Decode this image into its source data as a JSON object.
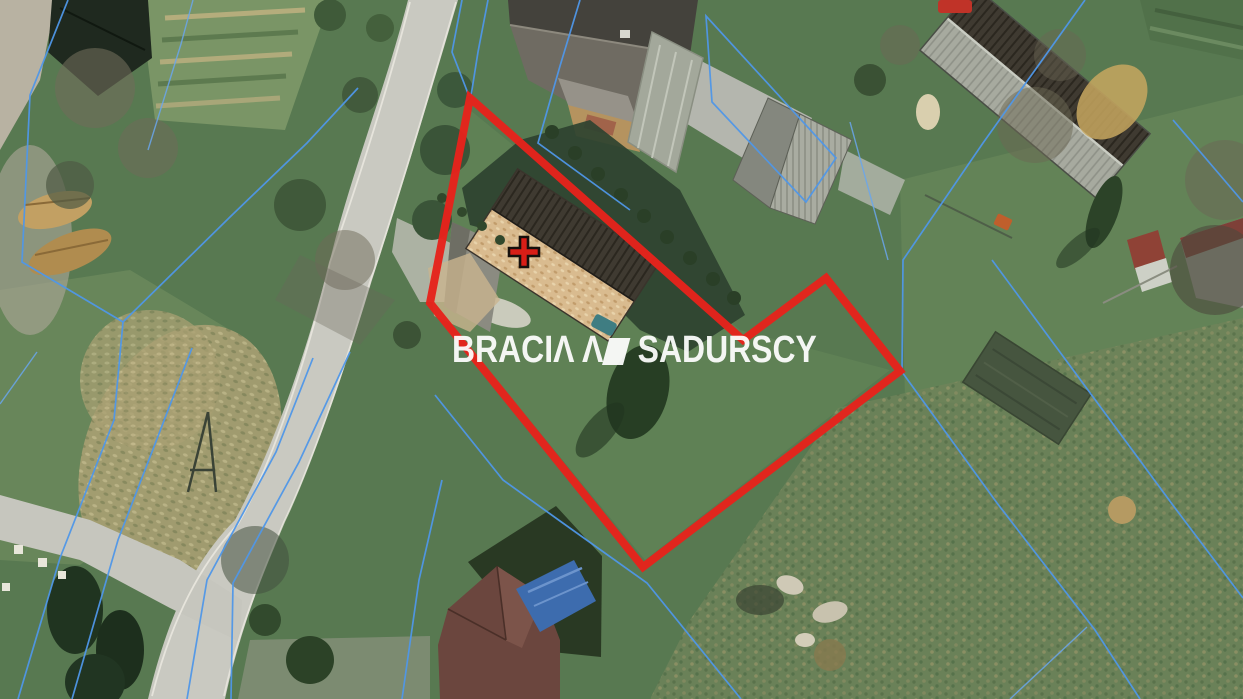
{
  "watermark": {
    "part1": "BRACI",
    "stylized_a": "Λ",
    "logo_peak": "Λ",
    "part2": "SADURSCY",
    "color": "#ffffff"
  },
  "boundary": {
    "points": "470,98 743,340 826,278 900,371 643,567 430,303",
    "color": "#e5231c",
    "stroke_width": 8
  },
  "marker": {
    "transform": "translate(524,252)",
    "color": "#d81e17"
  },
  "cadastral": {
    "color": "#4f97e8",
    "rect_points": "706,16 836,158 806,202 712,102",
    "lines": [
      "68,0 30,95 22,262 123,322",
      "123,322 230,217 307,143 358,88",
      "123,322 114,420 60,558 18,699",
      "192,348 118,540 72,699",
      "37,352 0,404",
      "193,0 181,44 148,150",
      "462,0 452,52 469,96",
      "488,0 478,52 471,96",
      "580,0 560,66 538,143 630,210",
      "435,395 503,480 560,521 647,583 741,699",
      "442,480 419,580 402,699",
      "313,358 276,452 207,580 187,699",
      "350,352 299,462 233,583 231,699",
      "1085,0 983,143 903,260 902,372 997,503 1095,630 1140,699",
      "992,260 1175,508 1243,598",
      "850,122 888,260",
      "1173,120 1243,202",
      "1087,627 1010,699"
    ]
  },
  "scene_colors": {
    "grass_base": "#587951",
    "road": "#c9c9c1",
    "dry_field": "#a89f72",
    "dark_trees": "#2a3f27",
    "roof_dark": "#413b32",
    "roof_tan": "#d9bb8f",
    "tarp_blue": "#3d6cae",
    "cadastral_blue": "#4f97e8",
    "boundary_red": "#e5231c"
  }
}
